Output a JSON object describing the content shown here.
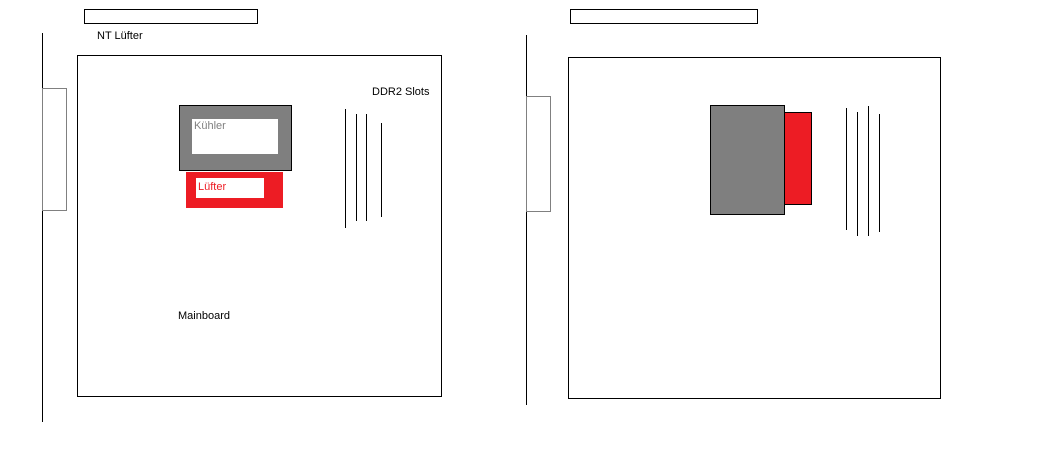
{
  "colors": {
    "background": "#ffffff",
    "outline": "#000000",
    "cooler_gray": "#7f7f7f",
    "fan_red": "#ed1c24",
    "bracket_border": "#808080",
    "cooler_label_gray": "#808080"
  },
  "left_diagram": {
    "nt_fan_label": "NT Lüfter",
    "ddr2_slots_label": "DDR2 Slots",
    "cooler_label": "Kühler",
    "fan_label": "Lüfter",
    "mainboard_label": "Mainboard"
  },
  "right_diagram": {}
}
